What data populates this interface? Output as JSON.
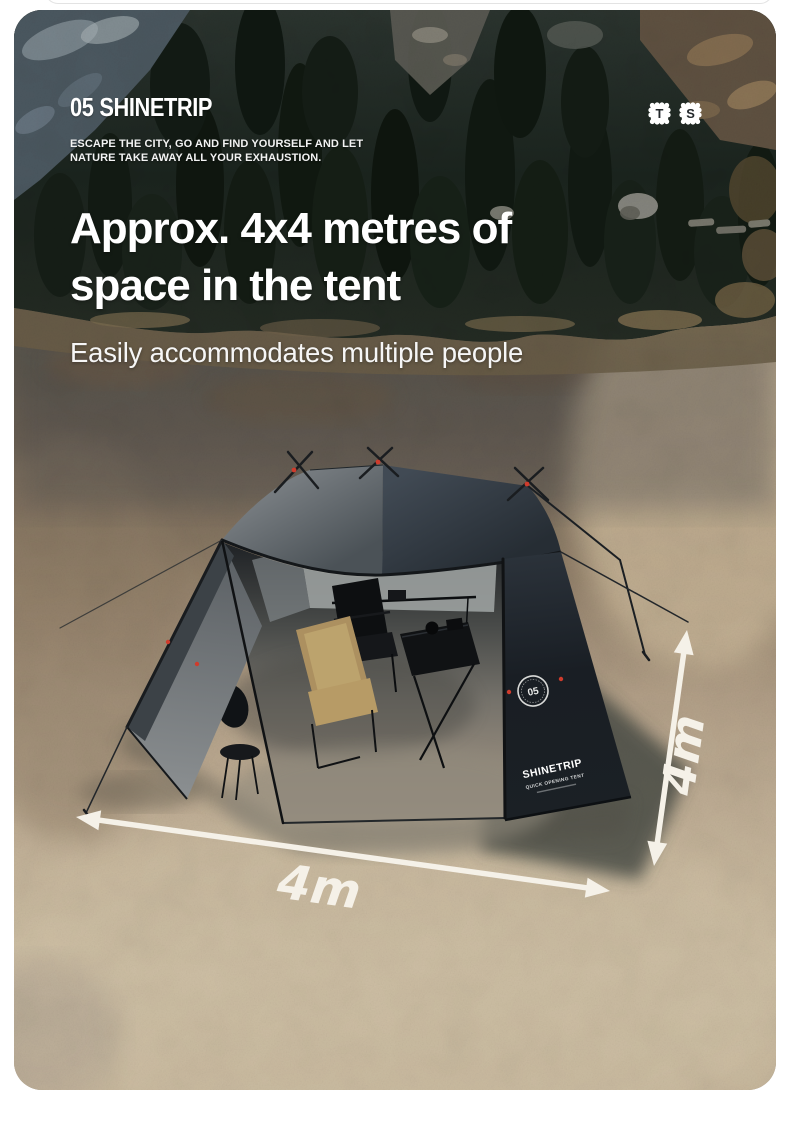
{
  "page": {
    "background": "#ffffff",
    "previous_card_edge_color": "#e3e3e3"
  },
  "header": {
    "logo_number": "05",
    "logo_name": "SHINETRIP",
    "tagline_line1": "ESCAPE THE CITY, GO AND FIND YOURSELF AND LET",
    "tagline_line2": "NATURE TAKE AWAY ALL YOUR EXHAUSTION.",
    "badges": [
      {
        "letter": "T"
      },
      {
        "letter": "S"
      }
    ]
  },
  "headline": {
    "line1": "Approx. 4x4 metres of",
    "line2": "space in the tent",
    "subtitle": "Easily accommodates multiple people"
  },
  "photo": {
    "dimension_width_label": "4m",
    "dimension_depth_label": "4m",
    "tent": {
      "badge_number": "05",
      "brand": "SHINETRIP",
      "model_line": "QUICK OPENING TENT"
    },
    "colors": {
      "headline_text": "#ffffff",
      "arrow": "#f5f1e8",
      "canopy_light": "#7b8084",
      "canopy_dark": "#37404a",
      "side_panel": "#171c21",
      "sand": "#c6b59a",
      "forest": "#1b231e",
      "accent_red": "#c8382a"
    }
  }
}
